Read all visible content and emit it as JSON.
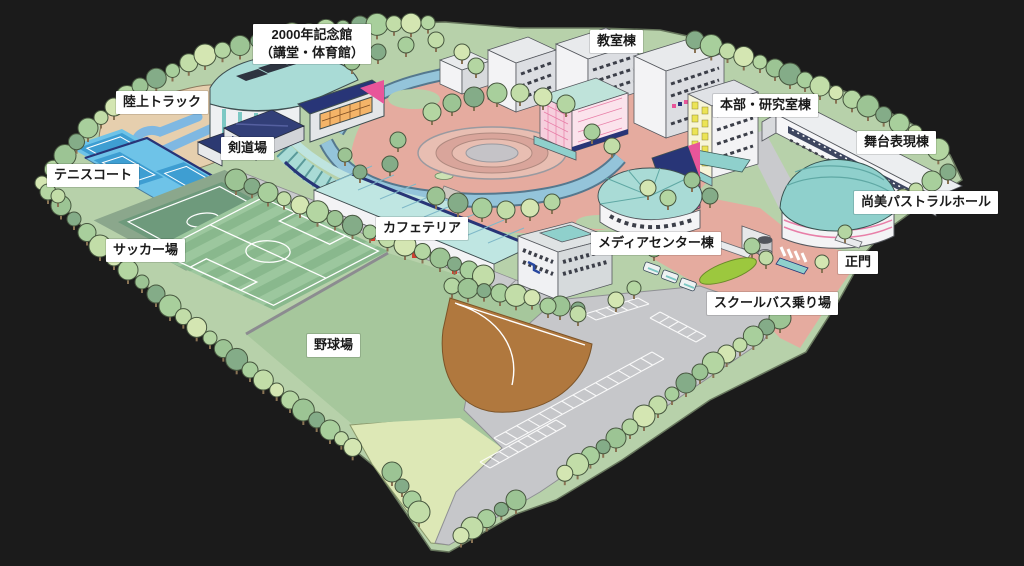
{
  "map": {
    "type": "illustrated-campus-map",
    "labels": [
      {
        "id": "memorial-hall",
        "text": "2000年記念館\n（講堂・体育館）"
      },
      {
        "id": "athletics-track",
        "text": "陸上トラック"
      },
      {
        "id": "kendo-hall",
        "text": "剣道場"
      },
      {
        "id": "tennis-courts",
        "text": "テニスコート"
      },
      {
        "id": "soccer-field",
        "text": "サッカー場"
      },
      {
        "id": "baseball-field",
        "text": "野球場"
      },
      {
        "id": "cafeteria",
        "text": "カフェテリア"
      },
      {
        "id": "classroom-building",
        "text": "教室棟"
      },
      {
        "id": "headquarters-research",
        "text": "本部・研究室棟"
      },
      {
        "id": "stage-expression-building",
        "text": "舞台表現棟"
      },
      {
        "id": "shobi-pastoral-hall",
        "text": "尚美パストラルホール"
      },
      {
        "id": "media-center-building",
        "text": "メディアセンター棟"
      },
      {
        "id": "main-gate",
        "text": "正門"
      },
      {
        "id": "school-bus-stop",
        "text": "スクールバス乗り場"
      }
    ],
    "palette": {
      "background": "#1b1b1b",
      "ground": "#b7d1aa",
      "ground_light": "#dde8b6",
      "baseball_green": "#a6c79c",
      "practice_green": "#6e9a7c",
      "soccer_a": "#9cc79e",
      "soccer_b": "#89b88d",
      "infield_brown": "#b0783e",
      "track_tan": "#e6cfae",
      "track_blue": "#7fb8e2",
      "tennis_light": "#6ec3e8",
      "tennis_court": "#3e9ed2",
      "water": "#94c4da",
      "water_edge": "#55788e",
      "plaza": "#e5ab9f",
      "plaza_ring": "#d9a59b",
      "plaza_ring_light": "#e8beb2",
      "parking": "#c6c7ca",
      "road_gray": "#c9cacd",
      "roof_teal": "#a9dbd6",
      "roof_teal_dark": "#8fd0cc",
      "navy": "#283577",
      "magenta": "#e8559a",
      "pink_wall": "#f6cfdd",
      "building_white": "#f3f3f5",
      "building_shade": "#dcdee2",
      "window_dark": "#3c3f49",
      "yellow_window": "#ece455",
      "orange_window": "#f4b468",
      "bus_green": "#9cc83e",
      "tree_outline": "#47573f",
      "trunk": "#8a7354",
      "tree_colors": [
        "#d4e6b2",
        "#b4d6a2",
        "#9cc494",
        "#84ac88",
        "#a8cf9c",
        "#c2dda8"
      ]
    }
  }
}
